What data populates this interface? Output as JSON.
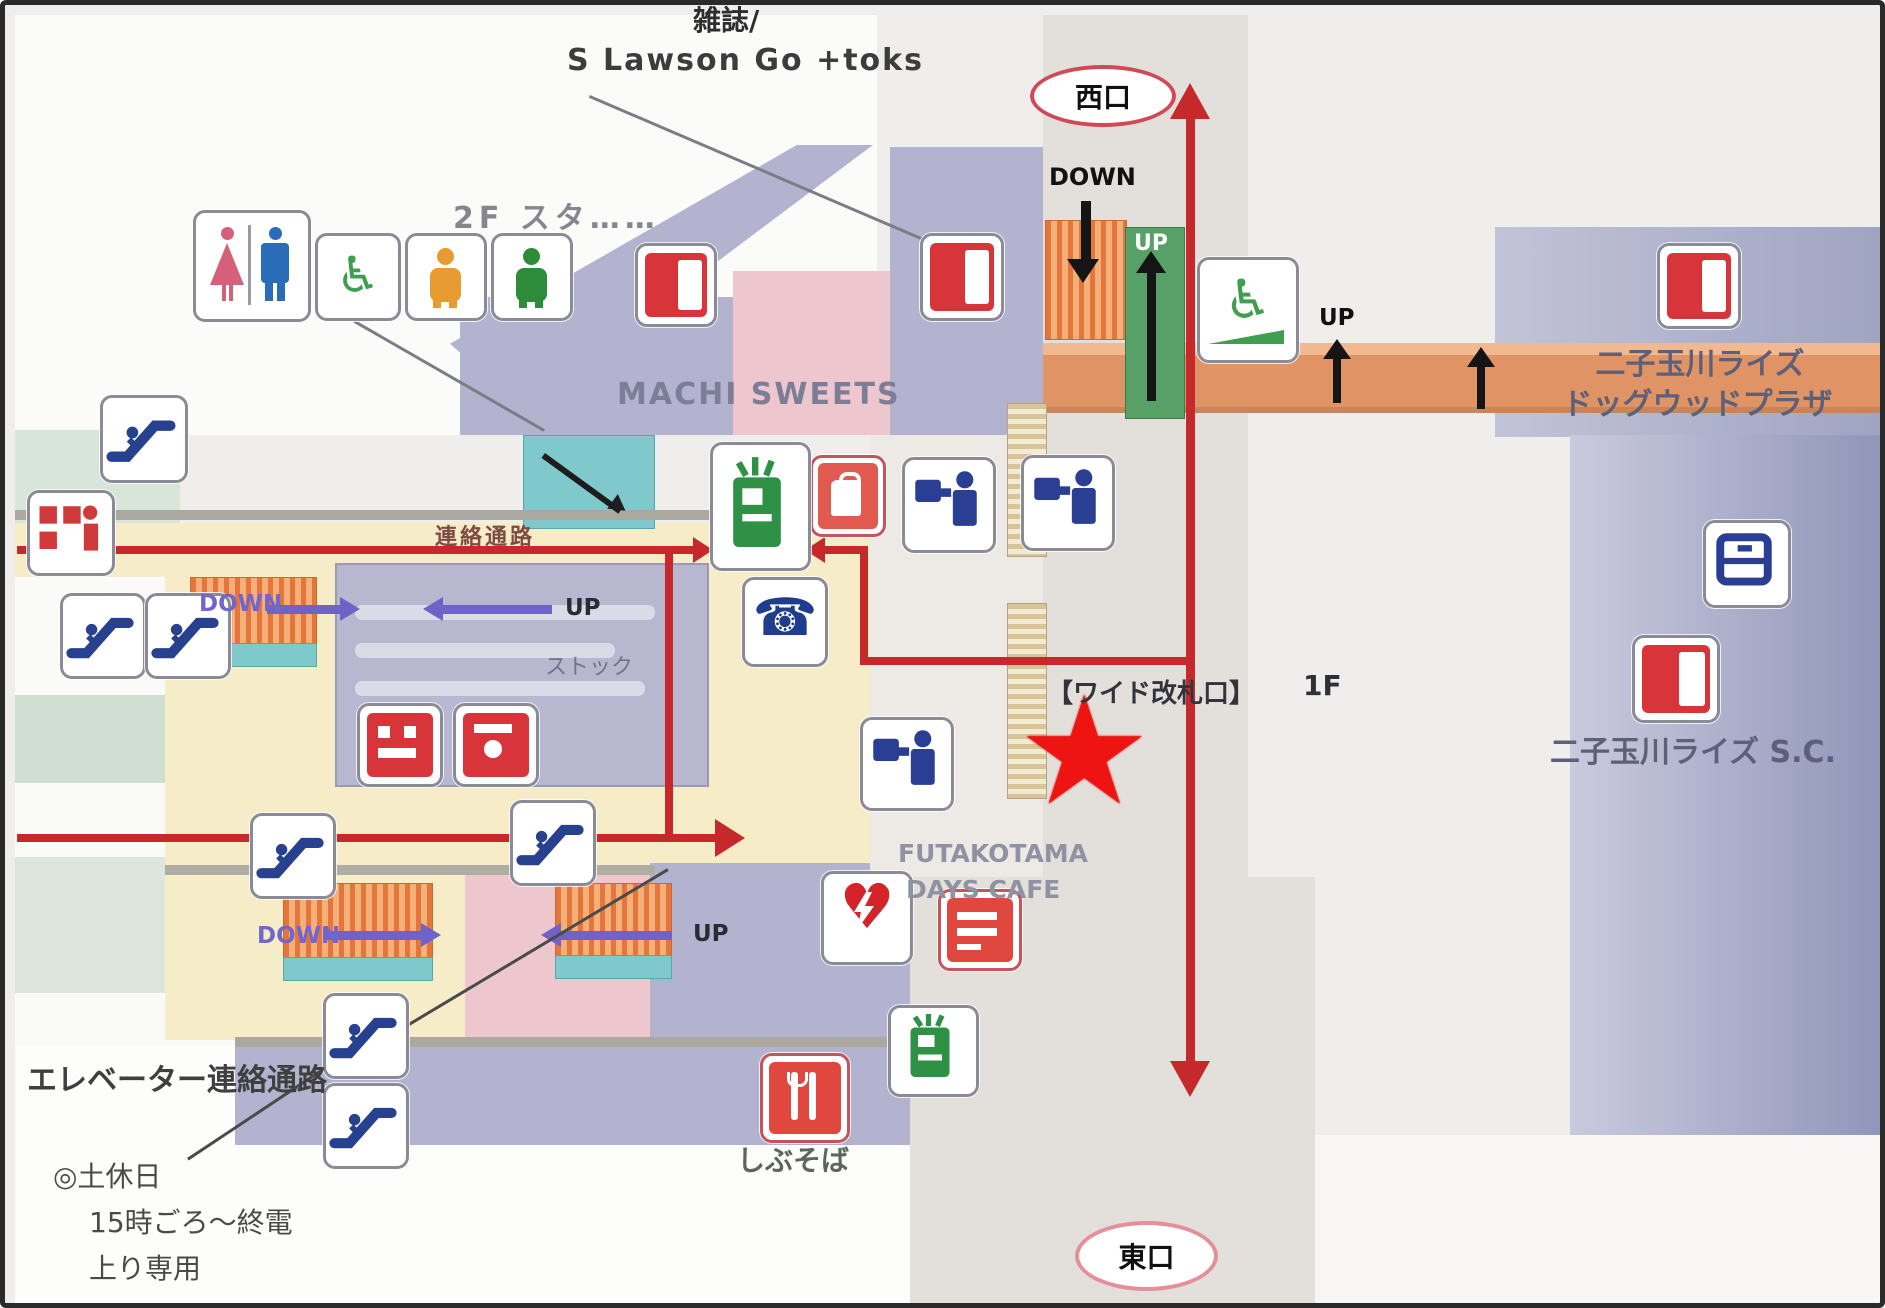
{
  "station_map": {
    "floor_shown": "1F",
    "exits": {
      "west": "西口",
      "east": "東口"
    },
    "buildings": {
      "dogwood_line1": "二子玉川ライズ",
      "dogwood_line2": "ドッグウッドプラザ",
      "rise_sc": "二子玉川ライズ S.C."
    }
  },
  "labels": {
    "magazine_note": "雑誌/",
    "lawson": "S Lawson Go +toks",
    "floor2": "2F スタ……",
    "sweets": "MACHI SWEETS",
    "corridor": "連絡通路",
    "wide_gate": "【ワイド改札口】",
    "floor1": "1F",
    "cafe_line1": "FUTAKOTAMA",
    "cafe_line2": "DAYS CAFE",
    "stock": "ストック",
    "elevator_corridor": "エレベーター連絡通路",
    "weekend_line1": "◎土休日",
    "weekend_line2": "15時ごろ〜終電",
    "weekend_line3": "上り専用",
    "shibusoba": "しぶそば",
    "down_top": "DOWN",
    "up_green": "UP",
    "up_walkway": "UP",
    "stair_down_upper": "DOWN",
    "stair_up_upper": "UP",
    "stair_down_lower": "DOWN",
    "stair_up_lower": "UP"
  },
  "icons": {
    "star_glyph": "★",
    "phone_glyph": "☎",
    "wheelchair_glyph": "♿",
    "slope_wheelchair_glyph": "♿",
    "aed_heart_glyph": "♥",
    "semantic_names": [
      "toilet-icon",
      "wheelchair-icon",
      "baby-room-icon",
      "kids-room-icon",
      "escalator-icon",
      "coin-locker-icon",
      "phone-icon",
      "ticket-office-icon",
      "ticket-vending-icon",
      "entrance-icon",
      "kiosk-icon",
      "fare-adjustment-icon",
      "aed-icon",
      "restaurant-icon",
      "accessible-slope-icon",
      "current-location-star"
    ]
  },
  "colors": {
    "route_red": "#c5292b",
    "star_red": "#ee1411",
    "building_lavender": "#b3b3cf",
    "building_pink": "#eec6cd",
    "concourse_cream": "#f6ecc8",
    "walkway_orange": "#e09465",
    "stair_orange": "#e5763b",
    "platform_teal": "#7fc9cd",
    "street_gray": "#e3dfda",
    "up_gate_green": "#57a068",
    "exit_oval_border": "#cf4a55"
  }
}
